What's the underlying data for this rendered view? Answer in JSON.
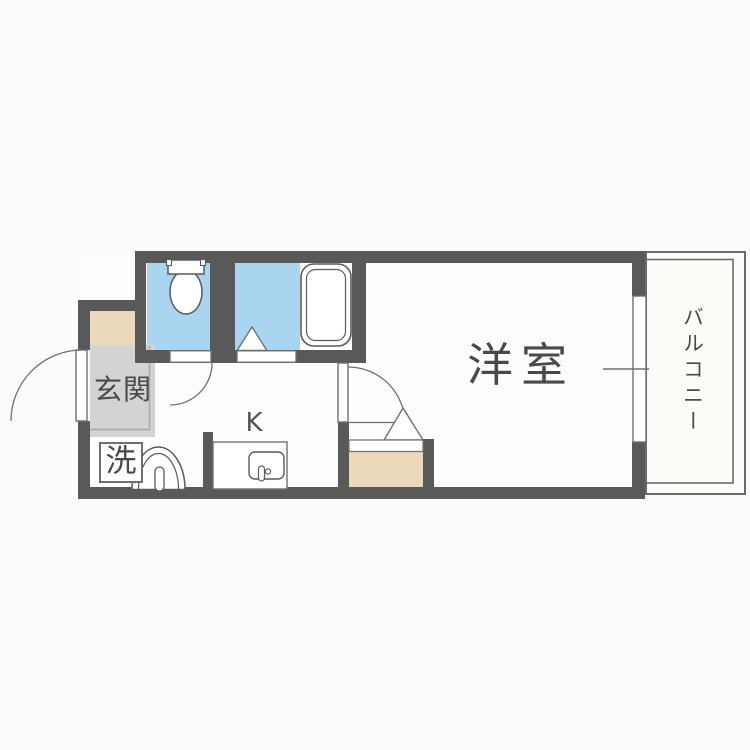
{
  "plan": {
    "type": "apartment-floor-plan",
    "labels": {
      "entrance": "玄関",
      "laundry": "洗",
      "kitchen": "K",
      "western_room": "洋室",
      "balcony": "バルコニー"
    },
    "fixtures": [
      "toilet-fixture",
      "bathtub-fixture",
      "bath-folding-door",
      "washbasin-fixture",
      "kitchen-sink-fixture",
      "laundry-space",
      "closet",
      "entrance-door-swing",
      "toilet-door-swing",
      "room-door-swing",
      "balcony-sliding-window",
      "balcony-railing"
    ],
    "colors": {
      "background": "#fbfbf9",
      "interior_floor": "#fdfdfc",
      "wall": "#595959",
      "wet_area_floor": "#a9d5f1",
      "step_and_closet": "#ecd8ba",
      "entrance_floor": "#d3d3d3",
      "outline": "#6a6a6a",
      "text": "#4a4a4a"
    }
  }
}
